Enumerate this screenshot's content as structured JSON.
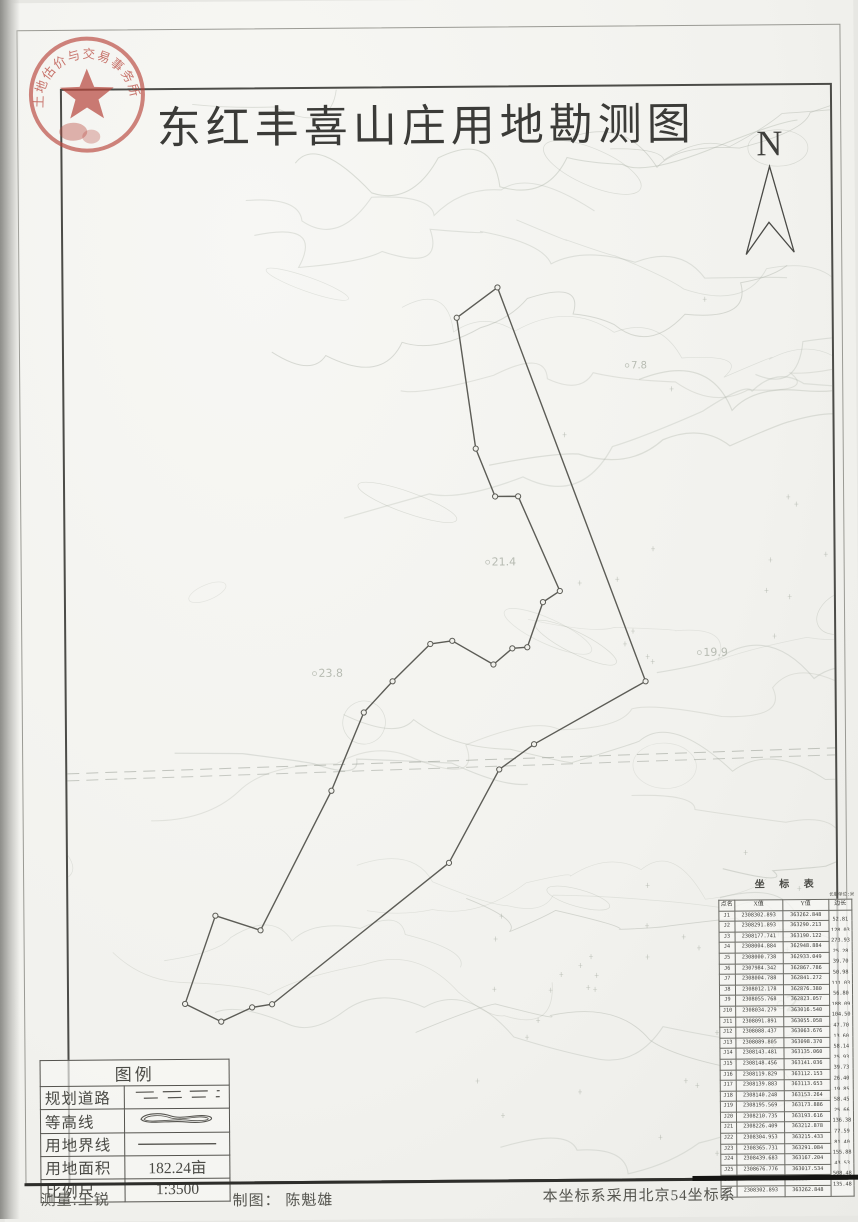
{
  "title": "东红丰喜山庄用地勘测图",
  "north_label": "N",
  "stamp": {
    "arc_text": "土地估价与交易事务所",
    "color": "#b8463c"
  },
  "legend": {
    "title": "图例",
    "rows": [
      {
        "label": "规划道路",
        "symbol": "planned-road"
      },
      {
        "label": "等高线",
        "symbol": "contour-line"
      },
      {
        "label": "用地界线",
        "symbol": "land-boundary"
      },
      {
        "label": "用地面积",
        "value": "182.24亩"
      },
      {
        "label": "比例尺",
        "value": "1:3500"
      }
    ]
  },
  "coordinate_table": {
    "title": "坐 标 表",
    "unit_note": "长度单位:米",
    "columns": [
      "点名",
      "X值",
      "Y值",
      "边长"
    ],
    "rows": [
      {
        "name": "J1",
        "x": "2308302.893",
        "y": "363262.848",
        "len": "52.81"
      },
      {
        "name": "J2",
        "x": "2308291.893",
        "y": "363290.213",
        "len": "128.03"
      },
      {
        "name": "J3",
        "x": "2308177.741",
        "y": "363190.122",
        "len": "273.93"
      },
      {
        "name": "J4",
        "x": "2308004.884",
        "y": "362948.884",
        "len": "25.28"
      },
      {
        "name": "J5",
        "x": "2308000.738",
        "y": "362933.049",
        "len": "39.70"
      },
      {
        "name": "J6",
        "x": "2307984.342",
        "y": "362867.786",
        "len": "50.98"
      },
      {
        "name": "J7",
        "x": "2308004.788",
        "y": "362841.272",
        "len": "111.03"
      },
      {
        "name": "J8",
        "x": "2308012.178",
        "y": "362876.380",
        "len": "56.80"
      },
      {
        "name": "J9",
        "x": "2308055.768",
        "y": "362823.057",
        "len": "188.09"
      },
      {
        "name": "J10",
        "x": "2308034.279",
        "y": "363016.540",
        "len": "104.50"
      },
      {
        "name": "J11",
        "x": "2308091.891",
        "y": "363055.058",
        "len": "47.70"
      },
      {
        "name": "J12",
        "x": "2308088.437",
        "y": "363063.676",
        "len": "13.60"
      },
      {
        "name": "J13",
        "x": "2308089.805",
        "y": "363098.370",
        "len": "58.14"
      },
      {
        "name": "J14",
        "x": "2308143.481",
        "y": "363135.060",
        "len": "25.93"
      },
      {
        "name": "J15",
        "x": "2308148.456",
        "y": "363141.036",
        "len": "39.73"
      },
      {
        "name": "J16",
        "x": "2308119.829",
        "y": "363112.153",
        "len": "26.40"
      },
      {
        "name": "J17",
        "x": "2308139.883",
        "y": "363113.653",
        "len": "19.85"
      },
      {
        "name": "J18",
        "x": "2308140.248",
        "y": "363153.264",
        "len": "58.45"
      },
      {
        "name": "J19",
        "x": "2308195.569",
        "y": "363173.886",
        "len": "25.66"
      },
      {
        "name": "J20",
        "x": "2308210.735",
        "y": "363193.616",
        "len": "136.38"
      },
      {
        "name": "J21",
        "x": "2308226.409",
        "y": "363212.878",
        "len": "77.59"
      },
      {
        "name": "J22",
        "x": "2308304.953",
        "y": "363215.433",
        "len": "81.40"
      },
      {
        "name": "J23",
        "x": "2308365.731",
        "y": "363291.084",
        "len": "155.88"
      },
      {
        "name": "J24",
        "x": "2308439.683",
        "y": "363167.204",
        "len": "43.53"
      },
      {
        "name": "J25",
        "x": "2308676.776",
        "y": "363017.534",
        "len": "508.48"
      },
      {
        "name": "J26",
        "x": "2308487.199",
        "y": "363362.343",
        "len": "135.48"
      },
      {
        "name": "J1",
        "x": "2308302.893",
        "y": "363262.848",
        "len": ""
      }
    ]
  },
  "footer": {
    "surveyor": "测量:王锐",
    "cartographer": "制图： 陈魁雄",
    "coord_note": "本坐标系采用北京54坐标系"
  },
  "map": {
    "boundary_points_px": [
      [
        500,
        288
      ],
      [
        459,
        318
      ],
      [
        477,
        449
      ],
      [
        496,
        497
      ],
      [
        519,
        497
      ],
      [
        560,
        592
      ],
      [
        543,
        603
      ],
      [
        527,
        648
      ],
      [
        512,
        649
      ],
      [
        493,
        665
      ],
      [
        452,
        641
      ],
      [
        430,
        644
      ],
      [
        392,
        681
      ],
      [
        363,
        712
      ],
      [
        330,
        790
      ],
      [
        258,
        929
      ],
      [
        213,
        914
      ],
      [
        182,
        1002
      ],
      [
        218,
        1020
      ],
      [
        249,
        1006
      ],
      [
        269,
        1003
      ],
      [
        447,
        863
      ],
      [
        498,
        770
      ],
      [
        533,
        745
      ],
      [
        645,
        683
      ]
    ],
    "spot_elevations": [
      {
        "label": "21.4",
        "x": 492,
        "y": 566,
        "size": 11
      },
      {
        "label": "23.8",
        "x": 318,
        "y": 676,
        "size": 11
      },
      {
        "label": "19.9",
        "x": 703,
        "y": 658,
        "size": 11
      },
      {
        "label": "7.8",
        "x": 633,
        "y": 370,
        "size": 10
      },
      {
        "label": "2",
        "x": 782,
        "y": 1014,
        "size": 22
      }
    ]
  },
  "colors": {
    "stamp_red": "#b8463c",
    "boundary_line": "#5c5c56",
    "contour_line": "#a9afa4",
    "frame": "#4c4c48"
  }
}
